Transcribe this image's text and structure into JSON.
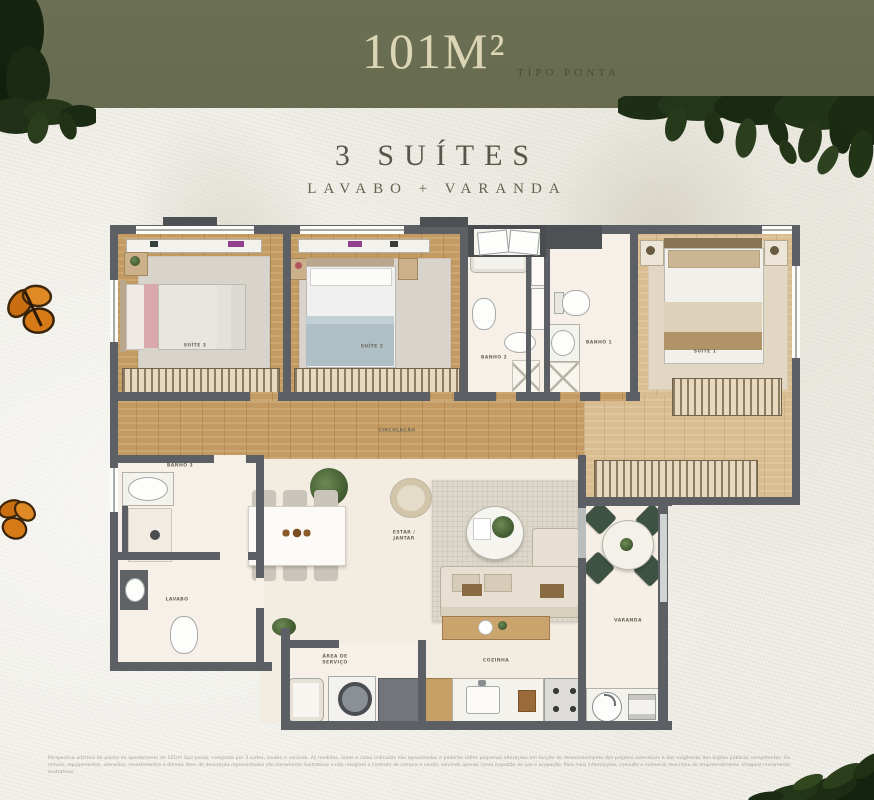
{
  "header": {
    "area": "101M²",
    "type": "TIPO PONTA"
  },
  "hero": {
    "title": "3 SUÍTES",
    "subtitle": "LAVABO + VARANDA"
  },
  "plan": {
    "labels": {
      "suite1": "SUÍTE 1",
      "suite2": "SUÍTE 2",
      "suite3": "SUÍTE 3",
      "banho1": "BANHO 1",
      "banho2": "BANHO 2",
      "banho3": "BANHO 3",
      "lavabo": "LAVABO",
      "circulacao": "CIRCULAÇÃO",
      "estar_jantar": "ESTAR / JANTAR",
      "cozinha": "COZINHA",
      "area_servico": "ÁREA DE SERVIÇO",
      "varanda": "VARANDA"
    }
  },
  "footer": {
    "disclaimer": "Perspectiva artística da planta do apartamento de 101m² tipo ponta, composta por 3 suítes, lavabo e varanda. As medidas, áreas e cotas indicadas são aproximadas e poderão sofrer pequenas alterações em função do desenvolvimento dos projetos executivos e das exigências dos órgãos públicos competentes. Os móveis, equipamentos, utensílios, revestimentos e demais itens de decoração representados são meramente ilustrativos e não integram o contrato de compra e venda, servindo apenas como sugestão de uso e ocupação. Para mais informações, consulte o memorial descritivo do empreendimento. Imagens meramente ilustrativas."
  },
  "colors": {
    "header_bg": "#676b4f",
    "header_text": "#ddd6b6",
    "wall": "#5c5f63",
    "wood": "#c39a61",
    "foliage": "#1e2d15",
    "butterfly": "#d57a16",
    "varanda_chair_green": "#3e5244"
  }
}
